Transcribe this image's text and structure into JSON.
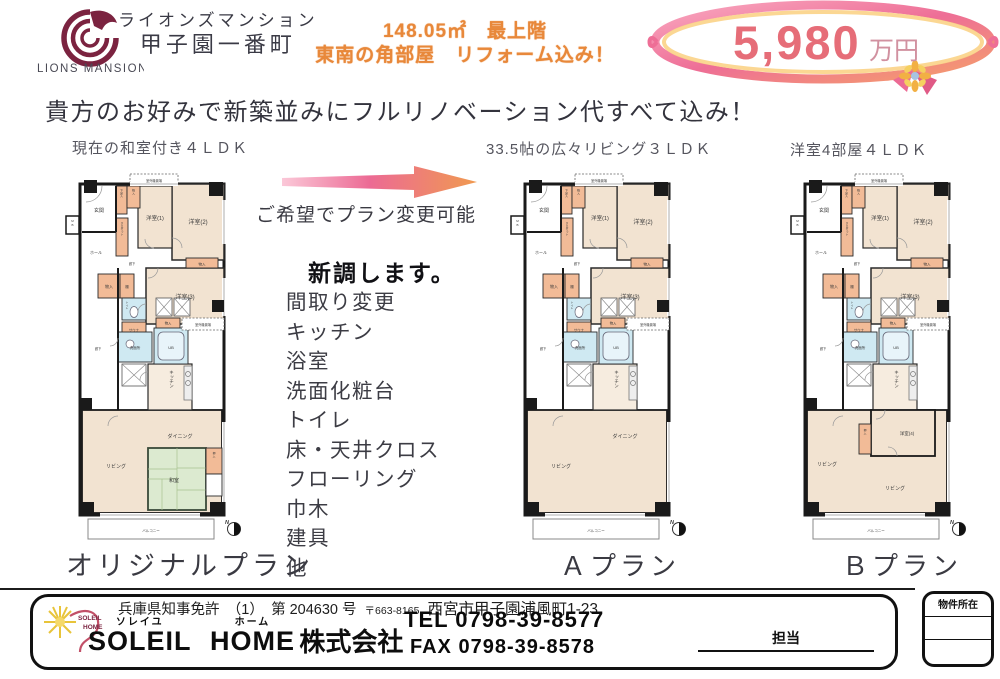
{
  "brand": {
    "logo_caption": "LIONS MANSION",
    "name_line1": "ライオンズマンション",
    "name_line2": "甲子園一番町"
  },
  "highlight": {
    "line1": "148.05㎡　最上階",
    "line2": "東南の角部屋　リフォーム込み！"
  },
  "price": {
    "amount": "5,980",
    "unit": "万円"
  },
  "headline": "貴方のお好みで新築並みにフルリノベーション代すべて込み！",
  "arrow_note": "ご希望でプラン変更可能",
  "renewal": {
    "title": "新調します。",
    "items": [
      "間取り変更",
      "キッチン",
      "浴室",
      "洗面化粧台",
      "トイレ",
      "床・天井クロス",
      "フローリング",
      "巾木",
      "建具",
      "他"
    ]
  },
  "plans": {
    "original": {
      "caption": "現在の和室付き４ＬＤＫ",
      "name": "オリジナルプラン"
    },
    "a": {
      "caption": "33.5帖の広々リビング３ＬＤＫ",
      "name": "Ａプラン"
    },
    "b": {
      "caption": "洋室4部屋４ＬＤＫ",
      "name": "Ｂプラン"
    }
  },
  "rooms": {
    "genkan": "玄関",
    "hall": "ホール",
    "rouka": "廊下",
    "mb": "MB",
    "yoshitsu1": "洋室(1)",
    "yoshitsu2": "洋室(2)",
    "yoshitsu3": "洋室(3)",
    "yoshitsu4": "洋室(4)",
    "monoire": "物入",
    "oshiire": "押入",
    "getabako": "下足入",
    "wic": "クロゼット",
    "tana": "棚",
    "toilet": "トイレ",
    "sauna": "サウナ",
    "senmenjo": "洗面所",
    "ub": "UB",
    "kitchen": "キッチン",
    "dining": "ダイニング",
    "living": "リビング",
    "washitsu": "和室",
    "balcony": "バルコニー",
    "outdoor_unit": "室外機置場",
    "north": "N"
  },
  "footer": {
    "license": "兵庫県知事免許　（1）　第 204630 号",
    "postal": "〒663-8165",
    "address": "西宮市甲子園浦風町1-23",
    "company": {
      "furi1": "ソレイユ",
      "en1": "SOLEIL",
      "furi2": "ホーム",
      "en2": "HOME",
      "suffix": "株式会社"
    },
    "tel_label": "TEL",
    "tel": "0798-39-8577",
    "fax_label": "FAX",
    "fax": "0798-39-8578",
    "staff_label": "担当",
    "stamp_label": "物件所在",
    "logo": {
      "line1": "SOLEIL",
      "line2": "HOME"
    }
  },
  "colors": {
    "accent_orange": "#e8883a",
    "price_pink": "#e66d78",
    "ribbon_pink": "#ee6e96",
    "room_beige": "#f2e3d1",
    "closet_orange": "#f2bb97",
    "wet_blue": "#cfe9f2",
    "tatami_green": "#dcead0",
    "logo_maroon": "#7b2340"
  }
}
